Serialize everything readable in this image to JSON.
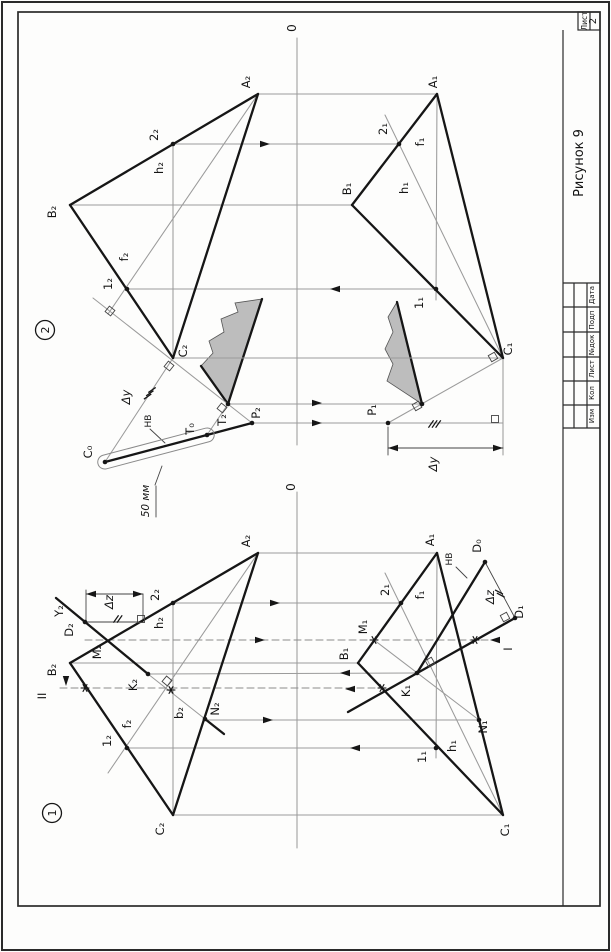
{
  "sheet": {
    "figure_caption": "Рисунок 9",
    "sheet_word": "Лист",
    "sheet_number": "2",
    "stamp_columns": [
      "Дата",
      "Подп",
      "№док",
      "Лист",
      "Кол",
      "Изм"
    ],
    "axis_label": "0"
  },
  "colors": {
    "line": "#161616",
    "gray": "#9b9b9b",
    "thin": "#444444",
    "fill": "#bdbdbd",
    "paper": "#fdfdfc"
  },
  "fig2": {
    "badge": {
      "x": 45,
      "y": 330,
      "t": "2"
    },
    "frags": [
      {
        "d": "M201,366 L213,353 L209,341 L224,332 L221,319 L238,312 L235,303 L262,299 L228,404 Z",
        "bold": [
          [
            201,
            366,
            228,
            404
          ],
          [
            228,
            404,
            262,
            299
          ]
        ]
      },
      {
        "d": "M397,302 L388,317 L393,332 L385,349 L393,364 L387,381 L422,404 Z",
        "bold": [
          [
            397,
            302,
            422,
            404
          ]
        ]
      }
    ],
    "gray": [
      [
        258,
        94,
        437,
        94
      ],
      [
        173,
        144,
        399,
        144
      ],
      [
        70,
        205,
        352,
        205
      ],
      [
        127,
        289,
        436,
        289
      ],
      [
        173,
        358,
        503,
        358
      ],
      [
        228,
        404,
        422,
        404
      ],
      [
        252,
        423,
        503,
        423
      ],
      [
        297,
        38,
        297,
        445
      ],
      [
        258,
        94,
        108,
        314
      ],
      [
        173,
        144,
        173,
        358
      ],
      [
        93,
        298,
        252,
        423
      ],
      [
        173,
        358,
        105,
        462
      ],
      [
        207,
        435,
        228,
        404
      ],
      [
        503,
        358,
        385,
        115
      ],
      [
        437,
        94,
        436,
        300
      ],
      [
        503,
        358,
        388,
        423
      ],
      [
        503,
        358,
        503,
        455
      ]
    ],
    "dashed": [],
    "thin": [
      [
        388,
        427,
        388,
        455
      ],
      [
        388,
        448,
        503,
        448
      ],
      [
        150,
        429,
        165,
        443
      ],
      [
        162,
        466,
        155,
        485
      ],
      [
        156,
        486,
        156,
        517
      ]
    ],
    "bold": [
      [
        258,
        94,
        70,
        205
      ],
      [
        70,
        205,
        173,
        358
      ],
      [
        173,
        358,
        258,
        94
      ],
      [
        437,
        94,
        352,
        205
      ],
      [
        352,
        205,
        503,
        358
      ],
      [
        503,
        358,
        437,
        94
      ],
      [
        105,
        462,
        252,
        423
      ]
    ],
    "capsule": {
      "x": 156,
      "y": 448.5,
      "len": 120,
      "w": 14,
      "a": -14.8
    },
    "squares": [
      [
        110,
        311,
        38
      ],
      [
        169,
        366,
        38
      ],
      [
        222,
        408,
        38
      ],
      [
        493,
        357,
        -30
      ],
      [
        417,
        406,
        -30
      ],
      [
        495,
        419,
        0
      ]
    ],
    "ticks": [
      [
        152,
        390,
        3,
        35,
        -2.2,
        3.3
      ],
      [
        431,
        424,
        3,
        55,
        3.6,
        0
      ]
    ],
    "dots": [
      [
        173,
        144
      ],
      [
        127,
        289
      ],
      [
        228,
        404
      ],
      [
        252,
        423
      ],
      [
        207,
        435
      ],
      [
        105,
        462
      ],
      [
        399,
        144
      ],
      [
        436,
        289
      ],
      [
        388,
        423
      ],
      [
        422,
        404
      ]
    ],
    "stars": [],
    "arrows": [
      [
        270,
        144,
        0
      ],
      [
        330,
        289,
        180
      ],
      [
        322,
        403,
        0
      ],
      [
        322,
        423,
        0
      ],
      [
        388,
        448,
        180
      ],
      [
        503,
        448,
        0
      ]
    ],
    "labels": [
      {
        "t": "0",
        "x": 296,
        "y": 28,
        "fs": 12
      },
      {
        "t": "A₂",
        "x": 250,
        "y": 82
      },
      {
        "t": "B₂",
        "x": 56,
        "y": 212
      },
      {
        "t": "C₂",
        "x": 187,
        "y": 351
      },
      {
        "t": "2₂",
        "x": 158,
        "y": 135
      },
      {
        "t": "h₂",
        "x": 163,
        "y": 168
      },
      {
        "t": "f₂",
        "x": 128,
        "y": 257
      },
      {
        "t": "1₂",
        "x": 112,
        "y": 284
      },
      {
        "t": "Δy",
        "x": 130,
        "y": 397,
        "it": 1
      },
      {
        "t": "НВ",
        "x": 151,
        "y": 421,
        "fs": 9
      },
      {
        "t": "T₀",
        "x": 194,
        "y": 429
      },
      {
        "t": "T₂",
        "x": 226,
        "y": 420
      },
      {
        "t": "P₂",
        "x": 260,
        "y": 413
      },
      {
        "t": "C₀",
        "x": 92,
        "y": 452
      },
      {
        "t": "A₁",
        "x": 437,
        "y": 82
      },
      {
        "t": "B₁",
        "x": 351,
        "y": 189
      },
      {
        "t": "C₁",
        "x": 512,
        "y": 349
      },
      {
        "t": "2₁",
        "x": 387,
        "y": 129
      },
      {
        "t": "f₁",
        "x": 424,
        "y": 142
      },
      {
        "t": "h₁",
        "x": 408,
        "y": 188
      },
      {
        "t": "1₁",
        "x": 423,
        "y": 303
      },
      {
        "t": "P₁",
        "x": 376,
        "y": 410
      },
      {
        "t": "Δy",
        "x": 437,
        "y": 464,
        "it": 1
      },
      {
        "t": "50 мм",
        "x": 149,
        "y": 501,
        "fs": 10.5,
        "it": 1
      }
    ]
  },
  "fig1": {
    "badge": {
      "x": 52,
      "y": 813,
      "t": "1"
    },
    "frags": [],
    "gray": [
      [
        258,
        553,
        437,
        553
      ],
      [
        173,
        603,
        401,
        603
      ],
      [
        70,
        663,
        358,
        663
      ],
      [
        173,
        815,
        503,
        815
      ],
      [
        205,
        720,
        479,
        720
      ],
      [
        127,
        748,
        436,
        748
      ],
      [
        148,
        674,
        417,
        673
      ],
      [
        297,
        492,
        297,
        848
      ],
      [
        258,
        553,
        108,
        773
      ],
      [
        173,
        603,
        173,
        815
      ],
      [
        148,
        674,
        205,
        719
      ],
      [
        503,
        815,
        385,
        573
      ],
      [
        437,
        553,
        436,
        758
      ],
      [
        374,
        640,
        479,
        720
      ]
    ],
    "dashed": [
      [
        85,
        640,
        497,
        640
      ],
      [
        60,
        688,
        390,
        688
      ]
    ],
    "thin": [
      [
        86,
        590,
        86,
        622
      ],
      [
        143,
        594,
        143,
        621
      ],
      [
        85,
        622,
        143,
        622
      ],
      [
        86,
        594,
        143,
        594
      ],
      [
        485,
        562,
        515,
        618
      ],
      [
        456,
        567,
        467,
        578
      ]
    ],
    "bold": [
      [
        258,
        553,
        70,
        663
      ],
      [
        70,
        663,
        173,
        815
      ],
      [
        173,
        815,
        258,
        553
      ],
      [
        437,
        553,
        358,
        663
      ],
      [
        358,
        663,
        503,
        815
      ],
      [
        503,
        815,
        437,
        553
      ],
      [
        56,
        598,
        148,
        674
      ],
      [
        205,
        719,
        224,
        734
      ],
      [
        515,
        618,
        348,
        712
      ],
      [
        485,
        562,
        417,
        673
      ]
    ],
    "capsule": null,
    "squares": [
      [
        167,
        681,
        40
      ],
      [
        430,
        662,
        -30
      ],
      [
        505,
        617,
        62
      ],
      [
        141,
        619,
        0
      ]
    ],
    "ticks": [
      [
        116,
        619,
        2,
        55,
        3.6,
        0
      ],
      [
        499,
        592,
        2,
        -28,
        1.8,
        3.2
      ]
    ],
    "dots": [
      [
        85,
        622
      ],
      [
        173,
        603
      ],
      [
        148,
        674
      ],
      [
        127,
        748
      ],
      [
        205,
        719
      ],
      [
        515,
        618
      ],
      [
        485,
        562
      ],
      [
        401,
        603
      ],
      [
        436,
        748
      ],
      [
        479,
        720
      ],
      [
        417,
        673
      ]
    ],
    "stars": [
      [
        374,
        640
      ],
      [
        475,
        640
      ],
      [
        85,
        688
      ],
      [
        171,
        690
      ],
      [
        382,
        688
      ]
    ],
    "arrows": [
      [
        280,
        603,
        0
      ],
      [
        265,
        640,
        0
      ],
      [
        273,
        720,
        0
      ],
      [
        350,
        748,
        180
      ],
      [
        340,
        673,
        180
      ],
      [
        345,
        689,
        180
      ],
      [
        490,
        640,
        180
      ],
      [
        66,
        686,
        90
      ],
      [
        86,
        594,
        180
      ],
      [
        143,
        594,
        0
      ]
    ],
    "labels": [
      {
        "t": "0",
        "x": 295,
        "y": 487,
        "fs": 12
      },
      {
        "t": "A₂",
        "x": 250,
        "y": 541
      },
      {
        "t": "B₂",
        "x": 56,
        "y": 670
      },
      {
        "t": "C₂",
        "x": 164,
        "y": 829
      },
      {
        "t": "2₂",
        "x": 159,
        "y": 595
      },
      {
        "t": "h₂",
        "x": 163,
        "y": 623
      },
      {
        "t": "Δz",
        "x": 113,
        "y": 602,
        "it": 1
      },
      {
        "t": "Y₂",
        "x": 63,
        "y": 611
      },
      {
        "t": "D₂",
        "x": 73,
        "y": 630
      },
      {
        "t": "M₂",
        "x": 101,
        "y": 652
      },
      {
        "t": "II",
        "x": 46,
        "y": 696
      },
      {
        "t": "K₂",
        "x": 137,
        "y": 685
      },
      {
        "t": "f₂",
        "x": 131,
        "y": 724
      },
      {
        "t": "b₂",
        "x": 183,
        "y": 713
      },
      {
        "t": "N₂",
        "x": 219,
        "y": 709
      },
      {
        "t": "1₂",
        "x": 111,
        "y": 741
      },
      {
        "t": "A₁",
        "x": 434,
        "y": 540
      },
      {
        "t": "D₀",
        "x": 481,
        "y": 546
      },
      {
        "t": "НВ",
        "x": 452,
        "y": 559,
        "fs": 9
      },
      {
        "t": "2₁",
        "x": 389,
        "y": 590
      },
      {
        "t": "f₁",
        "x": 424,
        "y": 595
      },
      {
        "t": "Δz",
        "x": 494,
        "y": 597,
        "it": 1
      },
      {
        "t": "D₁",
        "x": 523,
        "y": 612
      },
      {
        "t": "M₁",
        "x": 367,
        "y": 627
      },
      {
        "t": "B₁",
        "x": 348,
        "y": 654
      },
      {
        "t": "I",
        "x": 512,
        "y": 649
      },
      {
        "t": "K₁",
        "x": 410,
        "y": 691
      },
      {
        "t": "N₁",
        "x": 487,
        "y": 727
      },
      {
        "t": "h₁",
        "x": 456,
        "y": 746
      },
      {
        "t": "1₁",
        "x": 426,
        "y": 757
      },
      {
        "t": "C₁",
        "x": 509,
        "y": 830
      }
    ]
  }
}
